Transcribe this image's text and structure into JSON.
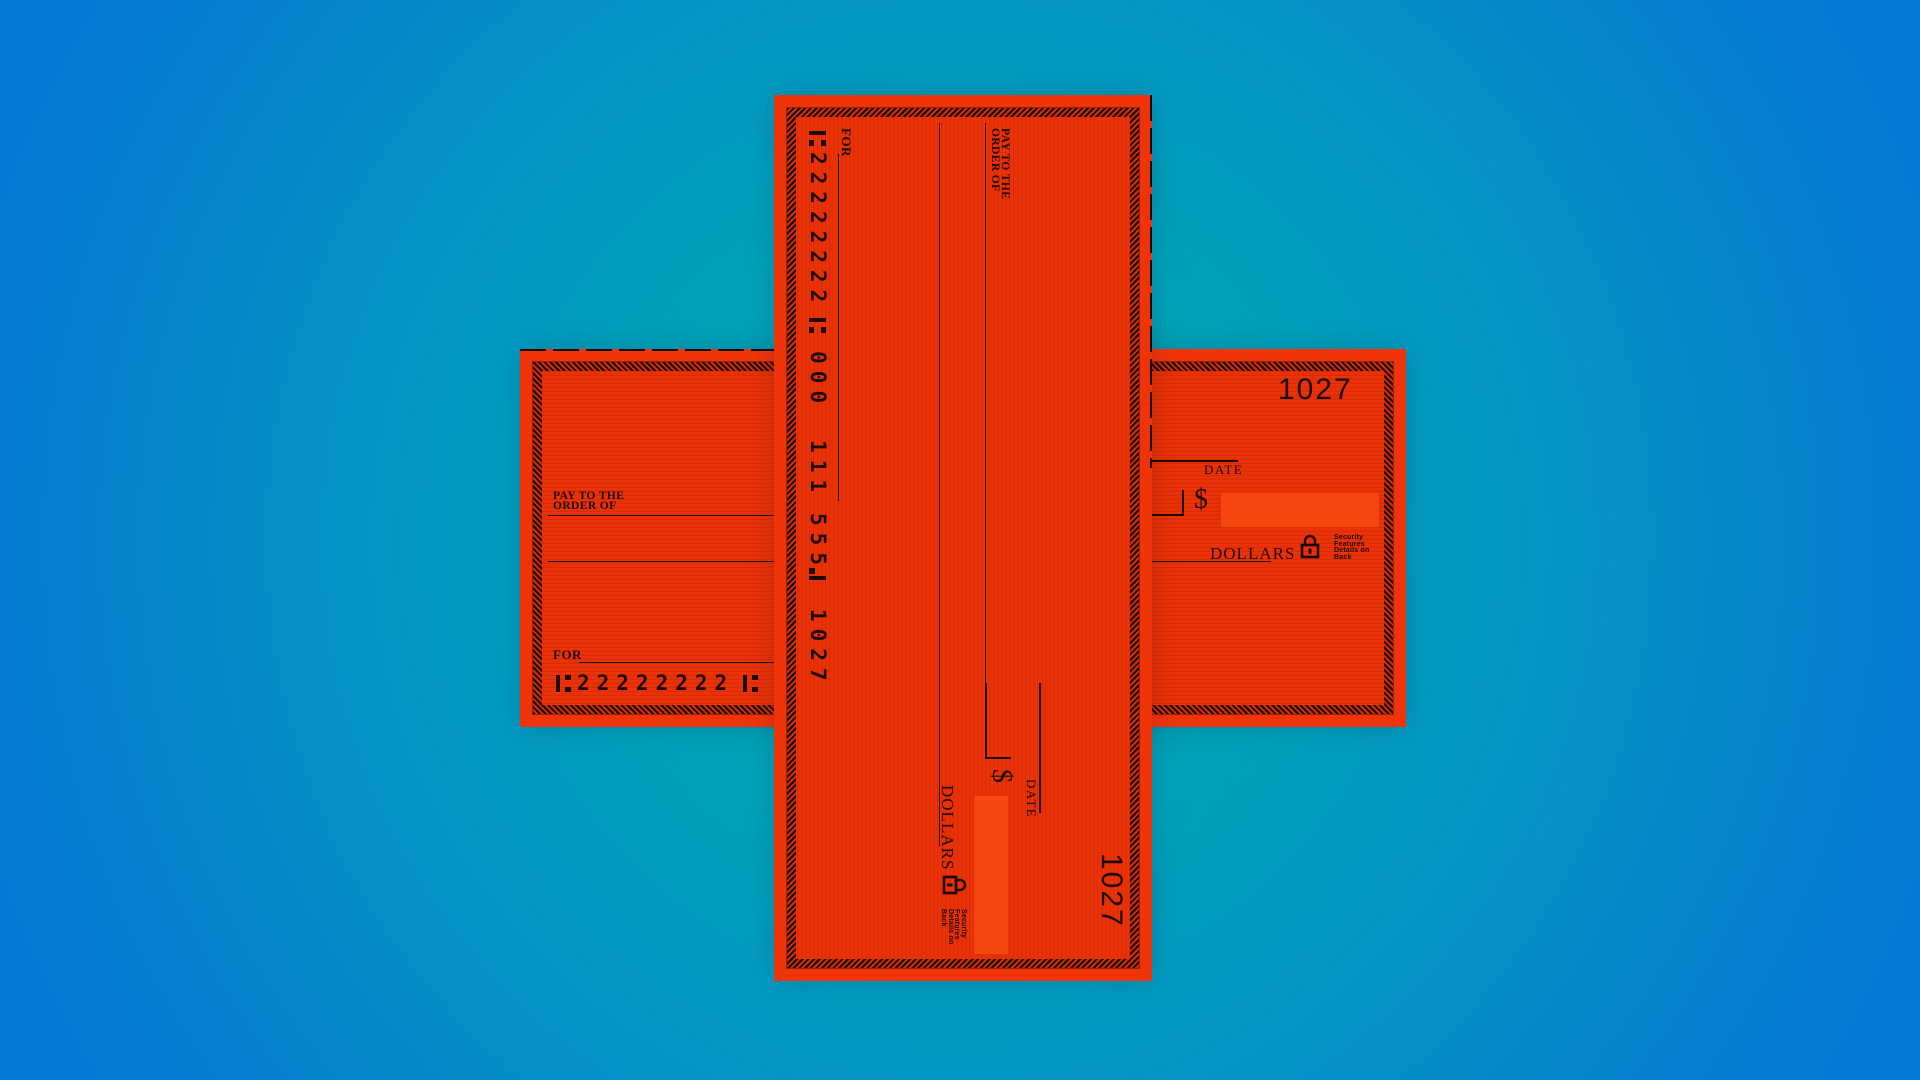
{
  "background": {
    "center_color": "#00a7ae",
    "edge_color": "#0574d8"
  },
  "check": {
    "paper_color": "#f0340a",
    "interior_color": "#ea3006",
    "amount_box_color": "#f6470f",
    "ink_color": "#1d0b02",
    "check_number": "1027",
    "labels": {
      "pay_to_line1": "PAY TO THE",
      "pay_to_line2": "ORDER OF",
      "date": "DATE",
      "dollar_sign": "$",
      "dollars": "DOLLARS",
      "for": "FOR"
    },
    "security_note_lines": [
      "Security",
      "Features",
      "Details on",
      "Back"
    ],
    "micr": {
      "routing": "22222222",
      "group1": "000",
      "group2": "111",
      "group3": "555",
      "check_number": "1027"
    }
  }
}
